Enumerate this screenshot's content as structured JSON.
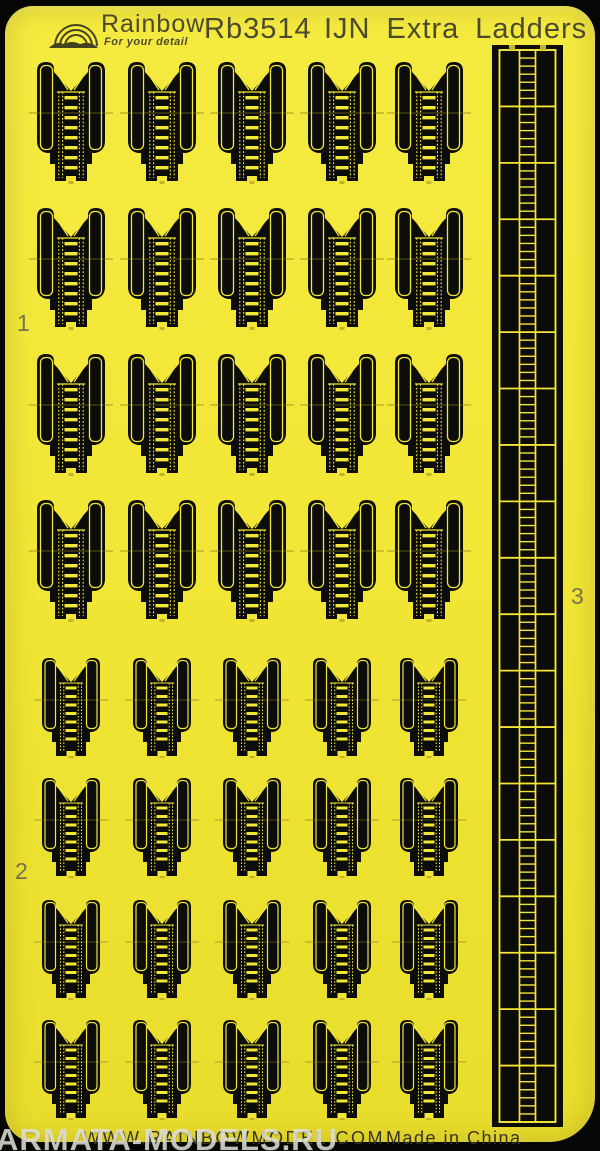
{
  "colors": {
    "sheet_yellow": "#f2e636",
    "sheet_yellow_hi": "#f5eb40",
    "sheet_yellow_lo": "#e9dd2c",
    "fret_black": "#0c0c0a",
    "detail_yellow": "#f2e636",
    "tab_yellow": "#c4b22a",
    "ink": "#4c4a2c",
    "label_ink": "#75724e",
    "footer_ink": "#35342a",
    "watermark": "rgba(230,230,223,0.82)"
  },
  "header": {
    "brand": "Rainbow",
    "tagline": "For your detail",
    "product_code": "Rb3514",
    "product_title": "IJN Extra Ladders"
  },
  "labels": {
    "group1": "1",
    "group2": "2",
    "group3": "3"
  },
  "footer": {
    "website": "WWW.RAINBOWMODEL.COM",
    "origin": "Made in China"
  },
  "watermark": {
    "text": "ARMATA-MODELS.RU"
  },
  "parts": {
    "column_centers": [
      71,
      162,
      252,
      342,
      429
    ],
    "rows": [
      {
        "type": "large",
        "top": 60
      },
      {
        "type": "large",
        "top": 206
      },
      {
        "type": "large",
        "top": 352
      },
      {
        "type": "large",
        "top": 498
      },
      {
        "type": "small",
        "top": 656
      },
      {
        "type": "small",
        "top": 776
      },
      {
        "type": "small",
        "top": 898
      },
      {
        "type": "small",
        "top": 1018
      }
    ],
    "large": {
      "width": 74,
      "height": 124,
      "rungs": 8
    },
    "small": {
      "width": 64,
      "height": 102,
      "rungs": 7
    },
    "part_counts": {
      "large_inclined_ladders": 20,
      "small_inclined_ladders": 20,
      "vertical_ladder_strip": 1
    }
  },
  "strip": {
    "left": 492,
    "top": 45,
    "width": 71,
    "height": 1082,
    "segments": 19,
    "rungs_per_segment": 7
  }
}
